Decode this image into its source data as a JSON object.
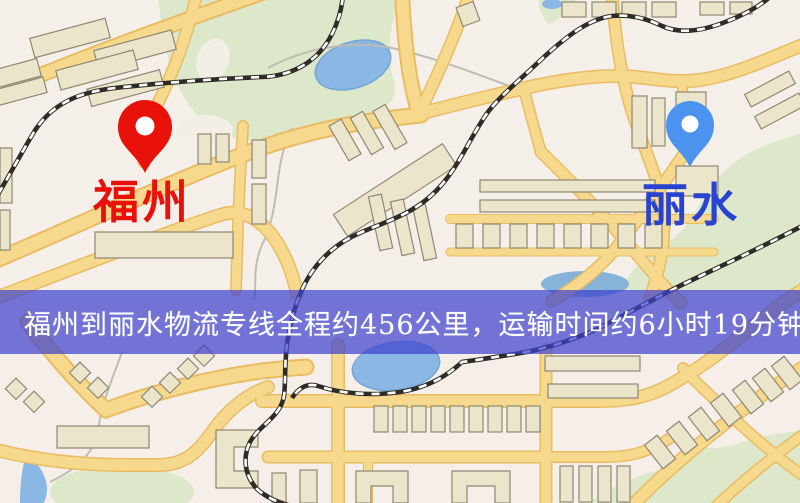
{
  "map": {
    "origin": {
      "name": "福州",
      "pin_color": "#e8120b",
      "label_color": "#e8120b"
    },
    "destination": {
      "name": "丽水",
      "pin_color": "#4b93ee",
      "label_color": "#2743d0"
    },
    "banner": {
      "text": "福州到丽水物流专线全程约456公里，运输时间约6小时19分钟.",
      "background_color": "#3e42cd",
      "text_color": "#ffffff"
    },
    "route_info": {
      "distance": "约456公里",
      "duration": "约6小时19分钟"
    },
    "palette": {
      "background": "#f5efe9",
      "road": "#f7d98d",
      "road_casing": "#e9bc63",
      "park": "#dde8cb",
      "water": "#8ab7e3",
      "building": "#ebe5cb",
      "railway": "#2f2c28"
    }
  }
}
